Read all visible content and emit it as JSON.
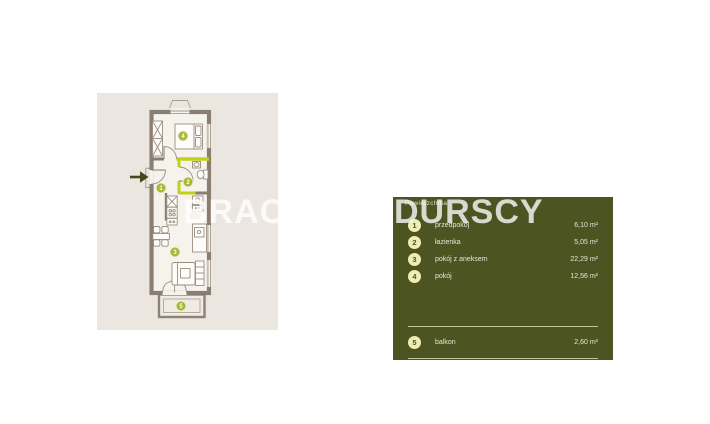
{
  "watermark": {
    "part1": "BRACIA",
    "part2": "DURSCY"
  },
  "panel": {
    "title": "Powierzchnia",
    "bg_color": "#4c5421",
    "badge_color": "#ededb4",
    "text_color": "#e8e6da",
    "rooms": [
      {
        "num": "1",
        "label": "przedpokój",
        "value": "6,10 m²"
      },
      {
        "num": "2",
        "label": "łazienka",
        "value": "5,05 m²"
      },
      {
        "num": "3",
        "label": "pokój z aneksem",
        "value": "22,29 m²"
      },
      {
        "num": "4",
        "label": "pokój",
        "value": "12,56 m²"
      },
      {
        "num": "5",
        "label": "balkon",
        "value": "2,60 m²"
      }
    ]
  },
  "floorplan": {
    "bg_color": "#ebe7e0",
    "wall_color": "#8a7d71",
    "highlight_wall_color": "#c2d118",
    "marker_color": "#a8b832",
    "arrow_color": "#43491d",
    "markers": [
      "1",
      "2",
      "3",
      "4",
      "5"
    ]
  }
}
